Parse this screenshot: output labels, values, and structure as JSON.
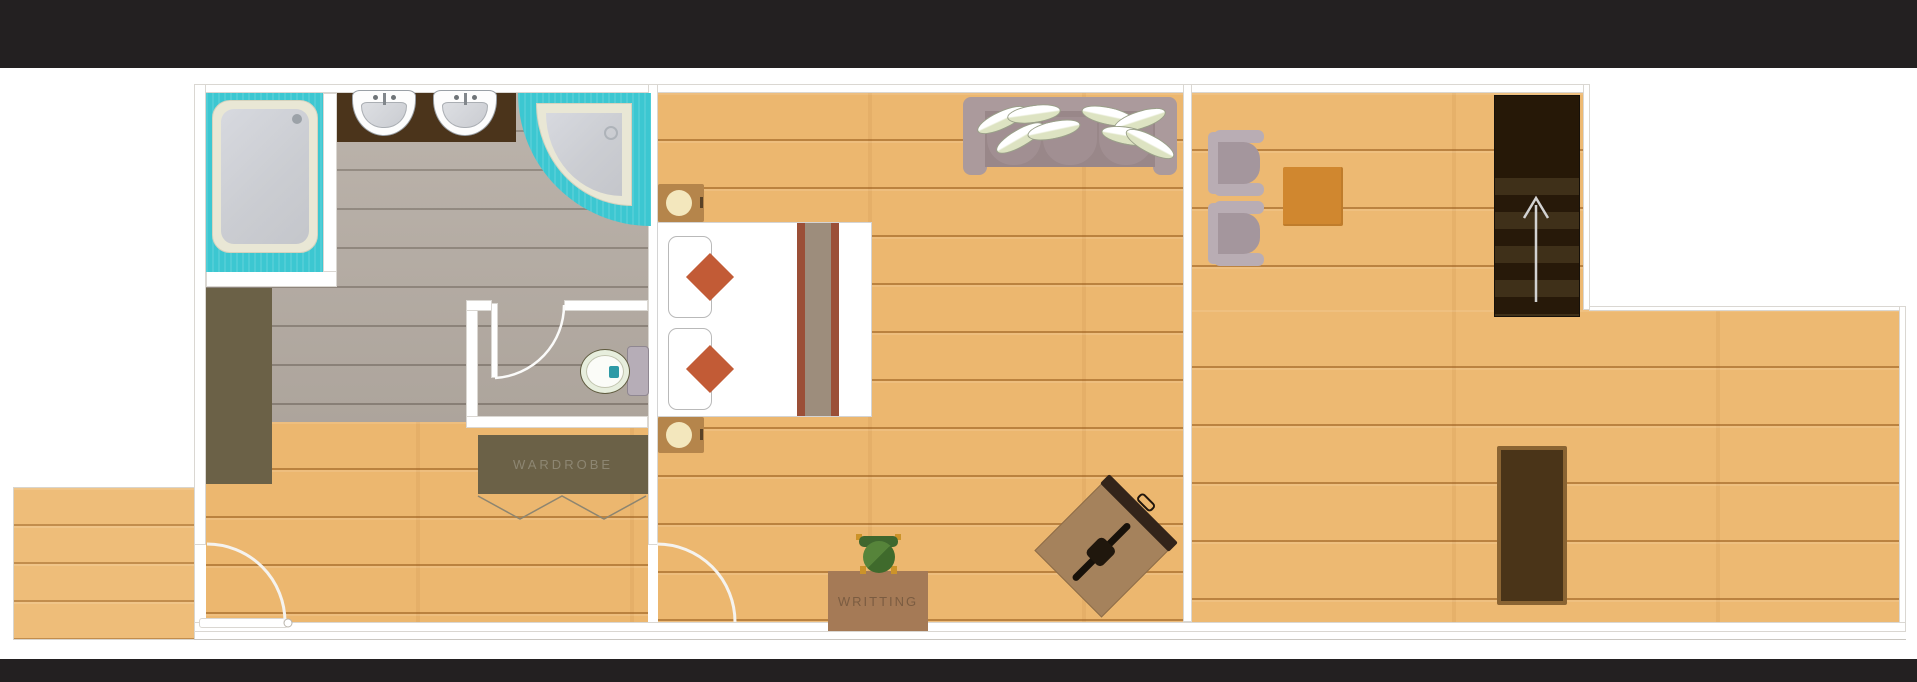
{
  "app": {
    "kind": "floor-plan viewer",
    "letterbox_color": "#232021",
    "canvas_background": "#ffffff"
  },
  "plan": {
    "labels": {
      "wardrobe": "WARDROBE",
      "writing_desk": "WRITTING"
    },
    "rooms": [
      {
        "name": "bathroom",
        "floor": "gray wood planks"
      },
      {
        "name": "toilet-room",
        "floor": "gray wood planks"
      },
      {
        "name": "hallway",
        "floor": "wood planks"
      },
      {
        "name": "bedroom",
        "floor": "wood planks"
      },
      {
        "name": "living-area",
        "floor": "wood planks"
      },
      {
        "name": "terrace",
        "floor": "wood planks"
      }
    ],
    "fixtures": [
      "square-shower",
      "corner-shower",
      "double-sink-vanity",
      "toilet",
      "bathroom-bench",
      "wardrobe",
      "entry-door",
      "toilet-door",
      "bedroom-door",
      "bed",
      "pillows",
      "accent-cushions",
      "nightstand-top",
      "nightstand-bottom",
      "sofa",
      "sofa-pillows",
      "writing-desk",
      "desk-chair",
      "luggage-rack",
      "armchair-1",
      "armchair-2",
      "side-table",
      "stairs-up",
      "console-desk"
    ],
    "colors": {
      "teal_tile": "#3cc7d1",
      "tray_rim": "#e9e7d5",
      "tray_base": "#cfd1d6",
      "wood": "#ecb76f",
      "gray_floor": "#b4aba2",
      "wall": "#ffffff",
      "wall_outline": "#dad7d2",
      "vanity_brown": "#4b341b",
      "olive": "#6b6147",
      "accent_diamond": "#c25b36",
      "bed_runner_red": "#9b4f37",
      "bed_runner_taupe": "#9d8d7c",
      "sofa_gray": "#a69496",
      "stairs_dark": "#261807",
      "stairs_tread": "#3f3019",
      "table_orange": "#d0872f",
      "desk_brown": "#a57a56",
      "console_dark": "#4a3418",
      "console_rim": "#8a6433",
      "luggage_tan": "#a5825c",
      "armchair_gray": "#b9adb4",
      "chair_green": "#4c7a33",
      "nightstand_brown": "#b5854b",
      "arrow_gray": "#d2d2d2"
    },
    "stairs_direction": "up"
  }
}
